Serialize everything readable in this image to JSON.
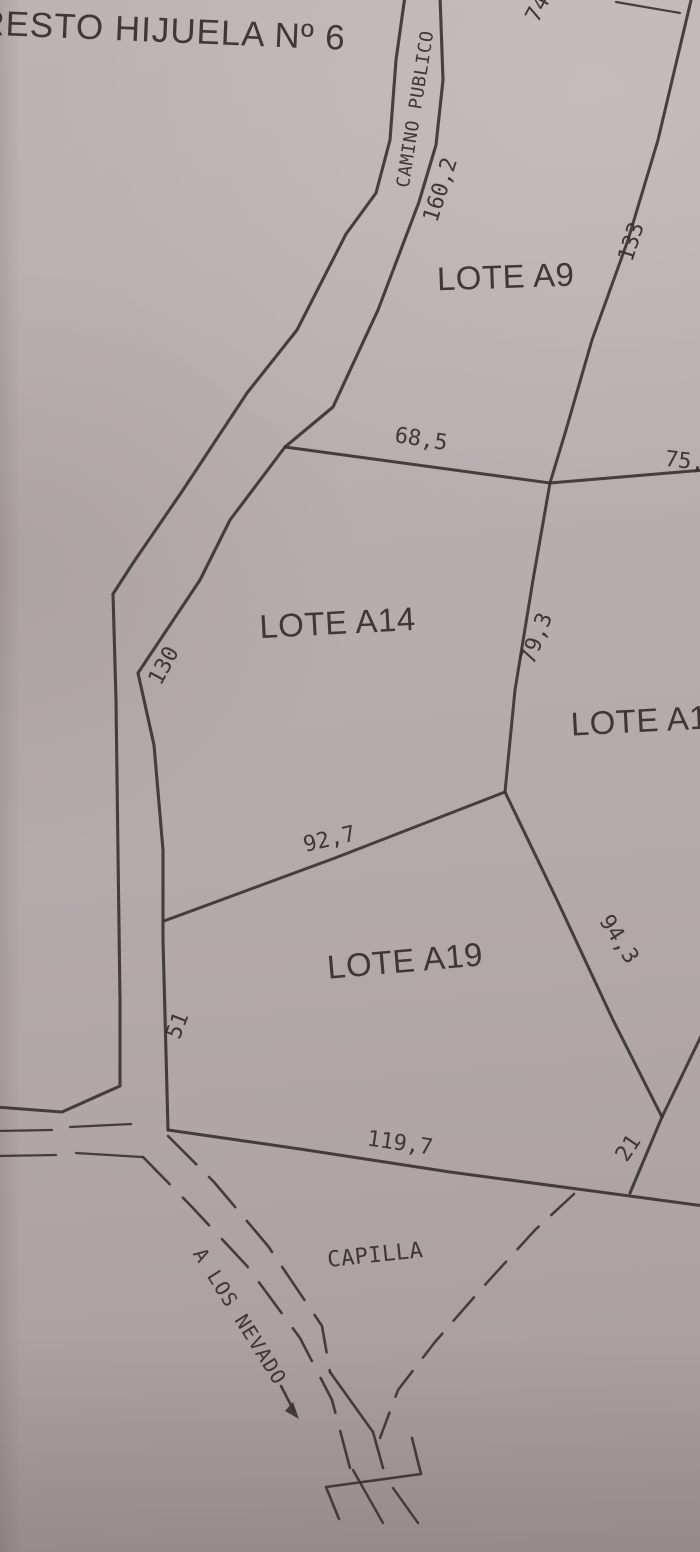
{
  "plan": {
    "title": "RESTO HIJUELA Nº 6",
    "road_name": "CAMINO PUBLICO",
    "landmark": "CAPILLA",
    "direction_note": "A LOS NEVADO",
    "lots": {
      "a9": "LOTE A9",
      "a14": "LOTE A14",
      "a19": "LOTE A19",
      "a1_partial": "LOTE A1"
    },
    "measurements": {
      "top_partial": "74",
      "road_side": "160,2",
      "a9_east": "133",
      "a14_north": "68,5",
      "east_partial": "75,",
      "a14_east": "79,3",
      "road_a14": "130",
      "a19_north": "92,7",
      "a19_east": "94,3",
      "road_a19": "51",
      "a19_south": "119,7",
      "southeast_short": "21"
    },
    "colors": {
      "ink": "#3a3334",
      "paper": "#b4acab"
    }
  }
}
